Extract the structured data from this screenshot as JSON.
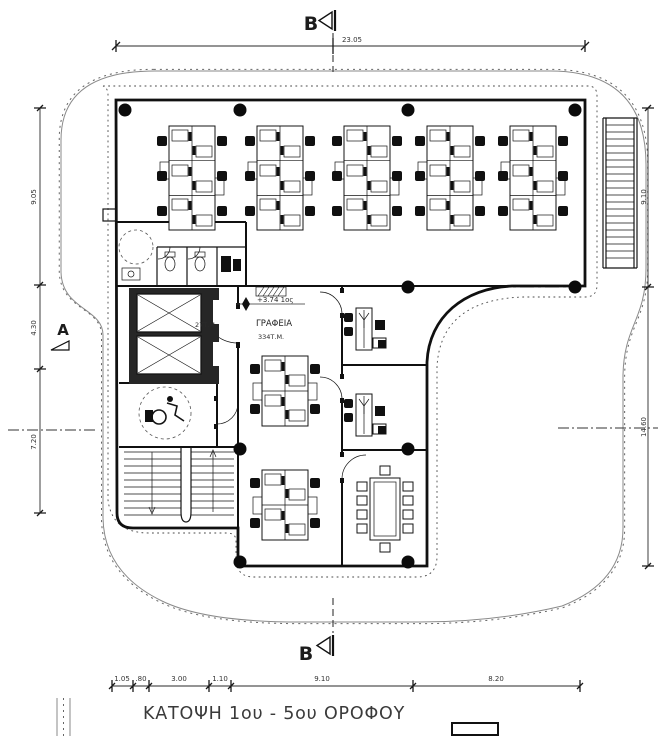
{
  "drawing": {
    "title": "ΚΑΤΟΨΗ 1ου - 5ου ΟΡΟΦΟΥ"
  },
  "markers": {
    "section_top": "B",
    "section_bottom": "B",
    "section_left": "A"
  },
  "labels": {
    "level": "+3.74 1ος",
    "room": "ΓΡΑΦΕΙΑ",
    "room_area": "334Τ.Μ.",
    "core_area": "27Τ.Μ."
  },
  "dims": {
    "top": [
      "23.05"
    ],
    "left": [
      "9.05",
      "4.30",
      "7.20"
    ],
    "right": [
      "9.10",
      "14.60"
    ],
    "bottom": [
      "1.05",
      ".80",
      "3.00",
      "1.10",
      "9.10",
      "8.20"
    ]
  },
  "colors": {
    "line": "#101010",
    "thin_line": "#555555",
    "text": "#2b2b2b",
    "paper": "#ffffff"
  },
  "plan": {
    "desk_clusters_6": [
      [
        169,
        126
      ],
      [
        257,
        126
      ],
      [
        344,
        126
      ],
      [
        427,
        126
      ],
      [
        510,
        126
      ]
    ],
    "desk_clusters_4": [
      [
        262,
        356
      ],
      [
        262,
        470
      ]
    ],
    "single_desks": [
      [
        356,
        308
      ],
      [
        356,
        394
      ]
    ],
    "meeting_tables": [
      [
        370,
        478
      ]
    ],
    "elevators": [
      [
        137,
        294
      ],
      [
        137,
        336
      ]
    ],
    "columns": [
      [
        125,
        110
      ],
      [
        240,
        110
      ],
      [
        408,
        110
      ],
      [
        575,
        110
      ],
      [
        408,
        287
      ],
      [
        575,
        287
      ],
      [
        240,
        449
      ],
      [
        408,
        449
      ],
      [
        240,
        562
      ],
      [
        408,
        562
      ]
    ]
  }
}
